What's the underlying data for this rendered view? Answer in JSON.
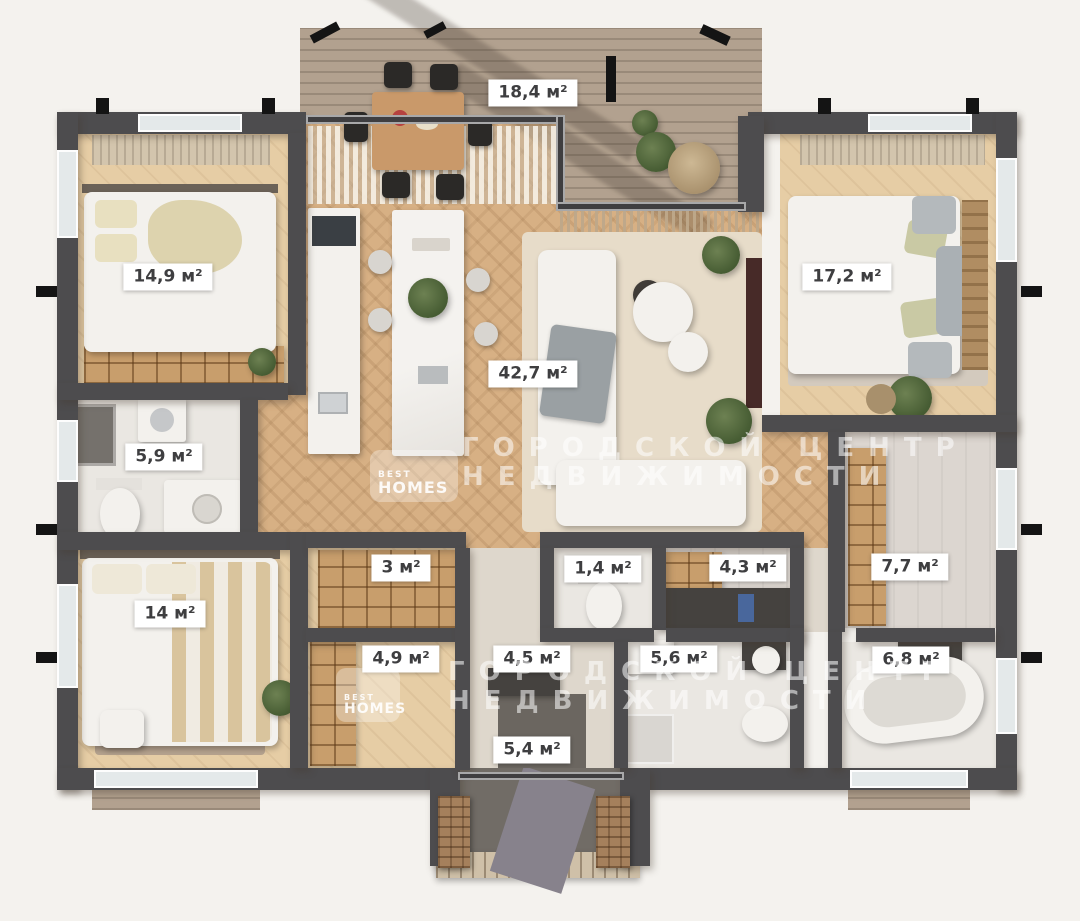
{
  "watermark": {
    "line1": "ГОРОДСКОЙ ЦЕНТР",
    "line2": "НЕДВИЖИМОСТИ",
    "brand_line1": "BEST",
    "brand_line2": "HOMES"
  },
  "colors": {
    "background": "#f4f2ee",
    "wall": "#4d4c4e",
    "wood_floor": "#d7b084",
    "bedroom_floor": "#e6cda5",
    "tile_floor": "#eae7e2",
    "deck": "#b2a18f",
    "label_bg": "#ffffff",
    "label_text": "#3e3e40"
  },
  "rooms": {
    "terrace": {
      "area_label": "18,4 м²"
    },
    "bedroom_top_left": {
      "area_label": "14,9 м²"
    },
    "bedroom_top_right": {
      "area_label": "17,2 м²"
    },
    "living_kitchen": {
      "area_label": "42,7 м²"
    },
    "bathroom_left": {
      "area_label": "5,9 м²"
    },
    "bedroom_bottom_left": {
      "area_label": "14 м²"
    },
    "closet": {
      "area_label": "3 м²"
    },
    "wc": {
      "area_label": "1,4 м²"
    },
    "storage": {
      "area_label": "4,3 м²"
    },
    "dressing_right": {
      "area_label": "7,7 м²"
    },
    "hall_left": {
      "area_label": "4,9 м²"
    },
    "entry_hall": {
      "area_label": "4,5 м²"
    },
    "bathroom_center": {
      "area_label": "5,6 м²"
    },
    "bathroom_right": {
      "area_label": "6,8 м²"
    },
    "porch": {
      "area_label": "5,4 м²"
    }
  }
}
